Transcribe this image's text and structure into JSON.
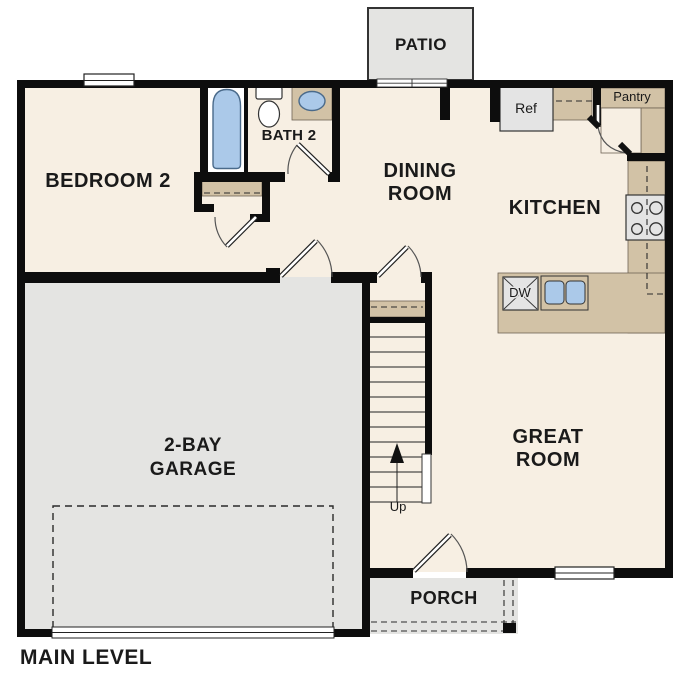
{
  "floor_plan": {
    "title": "MAIN LEVEL",
    "rooms": [
      {
        "name": "Bedroom 2",
        "lines": [
          "BEDROOM 2"
        ]
      },
      {
        "name": "Bath 2",
        "lines": [
          "BATH 2"
        ]
      },
      {
        "name": "Dining Room",
        "lines": [
          "DINING",
          "ROOM"
        ]
      },
      {
        "name": "Kitchen",
        "lines": [
          "KITCHEN"
        ]
      },
      {
        "name": "Great Room",
        "lines": [
          "GREAT",
          "ROOM"
        ]
      },
      {
        "name": "2-Bay Garage",
        "lines": [
          "2-BAY",
          "GARAGE"
        ]
      },
      {
        "name": "Patio",
        "lines": [
          "PATIO"
        ]
      },
      {
        "name": "Porch",
        "lines": [
          "PORCH"
        ]
      },
      {
        "name": "Pantry",
        "lines": [
          "Pantry"
        ]
      }
    ],
    "appliances": {
      "refrigerator": "Ref",
      "dishwasher": "DW"
    },
    "stairs": {
      "direction_label": "Up"
    },
    "colors": {
      "floor": "#f7efe3",
      "outdoor_gray": "#e4e4e2",
      "counter": "#d2c2a6",
      "water_blue": "#abc9e9",
      "appliance_gray": "#e4e4e4",
      "wall": "#0d0d0d"
    }
  }
}
